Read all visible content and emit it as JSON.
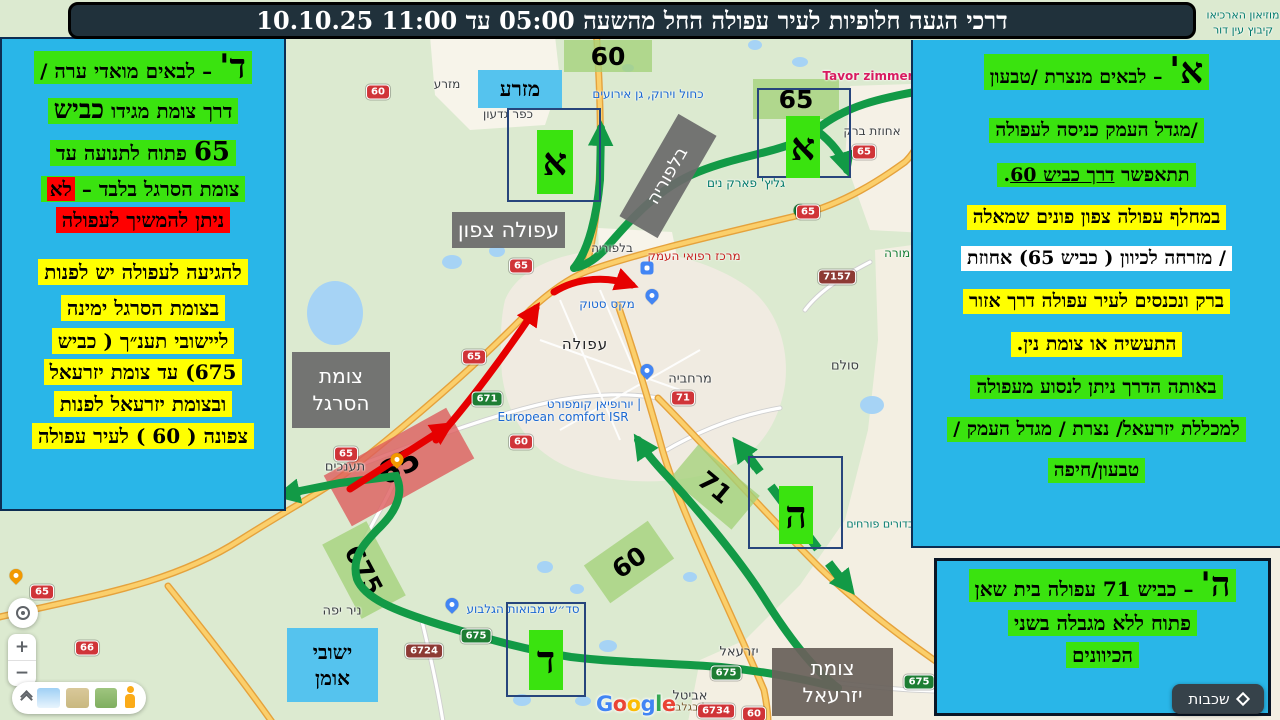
{
  "title": "דרכי הגעה חלופיות  לעיר עפולה החל מהשעה 05:00 עד 11:00 10.10.25",
  "panel_left": {
    "l1_big": "ד'",
    "l1_rest": " – לבאים מואדי ערה /",
    "l2_pre": "דרך צומת מגידו ",
    "l2_big": "כביש",
    "l3_big": "65",
    "l3_rest": " פתוח לתנועה עד",
    "l4_main": "צומת הסרגל בלבד – ",
    "l4_red": "לא",
    "l5": "ניתן להמשיך לעפולה",
    "l6": "להגיעה לעפולה יש לפנות",
    "l7": "בצומת הסרגל ימינה",
    "l8": "ליישובי תענ״ך ( כביש",
    "l9": "675) עד צומת יזרעאל",
    "l10": "ובצומת יזרעאל לפנות",
    "l11": "צפונה ( 60 ) לעיר עפולה"
  },
  "panel_right": {
    "l1_big": "א'",
    "l1_rest": " – לבאים מנצרת /טבעון",
    "l2": "/מגדל העמק כניסה לעפולה",
    "l3_pre": "תתאפשר ",
    "l3_underline": "דרך כביש 60",
    "l3_post": ".",
    "l4": "במחלף עפולה צפון פונים שמאלה",
    "l5": "/ מזרחה לכיוון ( כביש 65)  אחוזת",
    "l6": "ברק ונכנסים לעיר עפולה דרך אזור",
    "l7": "התעשיה או צומת נין.",
    "l8": "באותה הדרך ניתן לנסוע מעפולה",
    "l9": "למכללת יזרעאל/ נצרת / מגדל העמק /",
    "l10": "טבעון/חיפה"
  },
  "panel_bottom_right": {
    "l1_big": "ה'",
    "l1_rest": " – כביש 71 עפולה בית שאן",
    "l2": "פתוח ללא מגבלה בשני",
    "l3": "הכיוונים"
  },
  "markers": {
    "alef": "א",
    "dalet": "ד",
    "hey": "ה"
  },
  "badges": {
    "b60_top": "60",
    "b65_top": "65",
    "b65_closed": "65",
    "b675": "675",
    "b60_bottom": "60",
    "b71": "71"
  },
  "labels": {
    "afula_north": "עפולה צפון",
    "sargel_1": "צומת",
    "sargel_2": "הסרגל",
    "balfouria": "בלפוריה",
    "yizreel_1": "צומת",
    "yizreel_2": "יזרעאל",
    "mizra": "מזרע",
    "oman_1": "ישובי",
    "oman_2": "אומן"
  },
  "shields": {
    "s60": "60",
    "s65": "65",
    "s66": "66",
    "s71": "71",
    "s671": "671",
    "s675": "675",
    "s6724": "6724",
    "s6734": "6734",
    "s7157": "7157"
  },
  "poi": {
    "mizra_small": "מזרע",
    "kfar_gideon": "כפר גדעון",
    "balfouria_small": "בלפוריה",
    "ahuzat_barak": "אחוזת ברק",
    "tavor": "Tavor zimmer",
    "kachol": "כחול וירוק, גן אירועים",
    "glitz": "גליץ' פארק נים",
    "medical": "מרכז רפואי העמק",
    "max_stock": "מקס סטוק",
    "afula": "עפולה",
    "merhavia": "מרחביה",
    "sulam": "סולם",
    "hamore": "המורה",
    "european_he": "יורופיאן קומפורט |",
    "european_en": "European comfort ISR",
    "taanakhim": "תענכים",
    "nir_yafe": "ניר יפה",
    "mevoot": "סד״ש מבואות הגלבוע",
    "avital": "אביטל",
    "yizreel": "יזרעאל",
    "museum": "מוזיאון הארכיאו",
    "ein_dor": "קיבוץ עין דור",
    "tel_adashim": "תל עדשים",
    "gilboa": "יזרעאל בגלבוע",
    "balloons": "כדורים פורחים"
  },
  "controls": {
    "layers": "שכבות",
    "zoom_in": "+",
    "zoom_out": "−",
    "google": [
      "G",
      "o",
      "o",
      "g",
      "l",
      "e"
    ]
  }
}
